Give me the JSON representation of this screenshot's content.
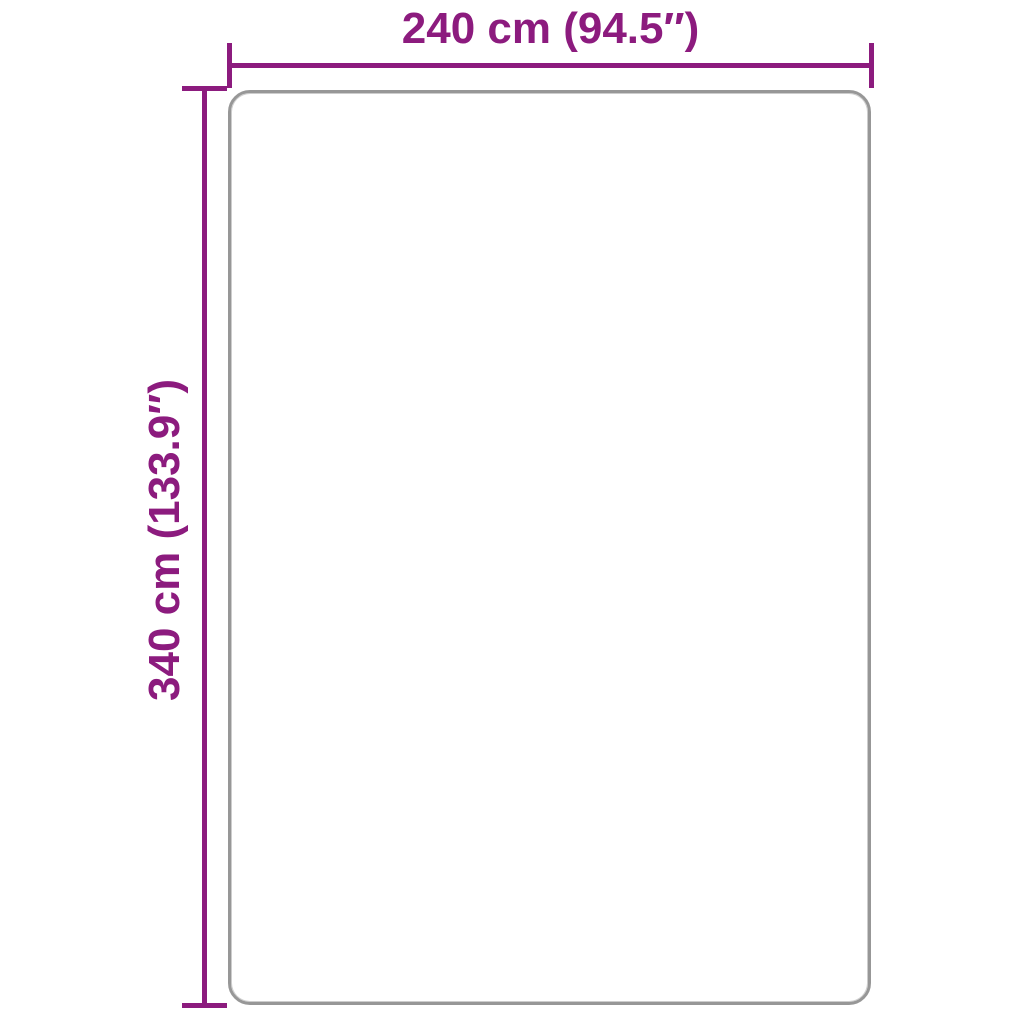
{
  "diagram": {
    "type": "product-dimension-diagram",
    "product_shape": "rounded-rectangle",
    "dimensions": {
      "width_label": "240 cm (94.5″)",
      "width_cm": 240,
      "width_inches": 94.5,
      "height_label": "340 cm (133.9″)",
      "height_cm": 340,
      "height_inches": 133.9
    }
  },
  "colors": {
    "dimension_accent": "#8C1B7E",
    "product_outline": "#979797",
    "background": "#FFFFFF"
  }
}
